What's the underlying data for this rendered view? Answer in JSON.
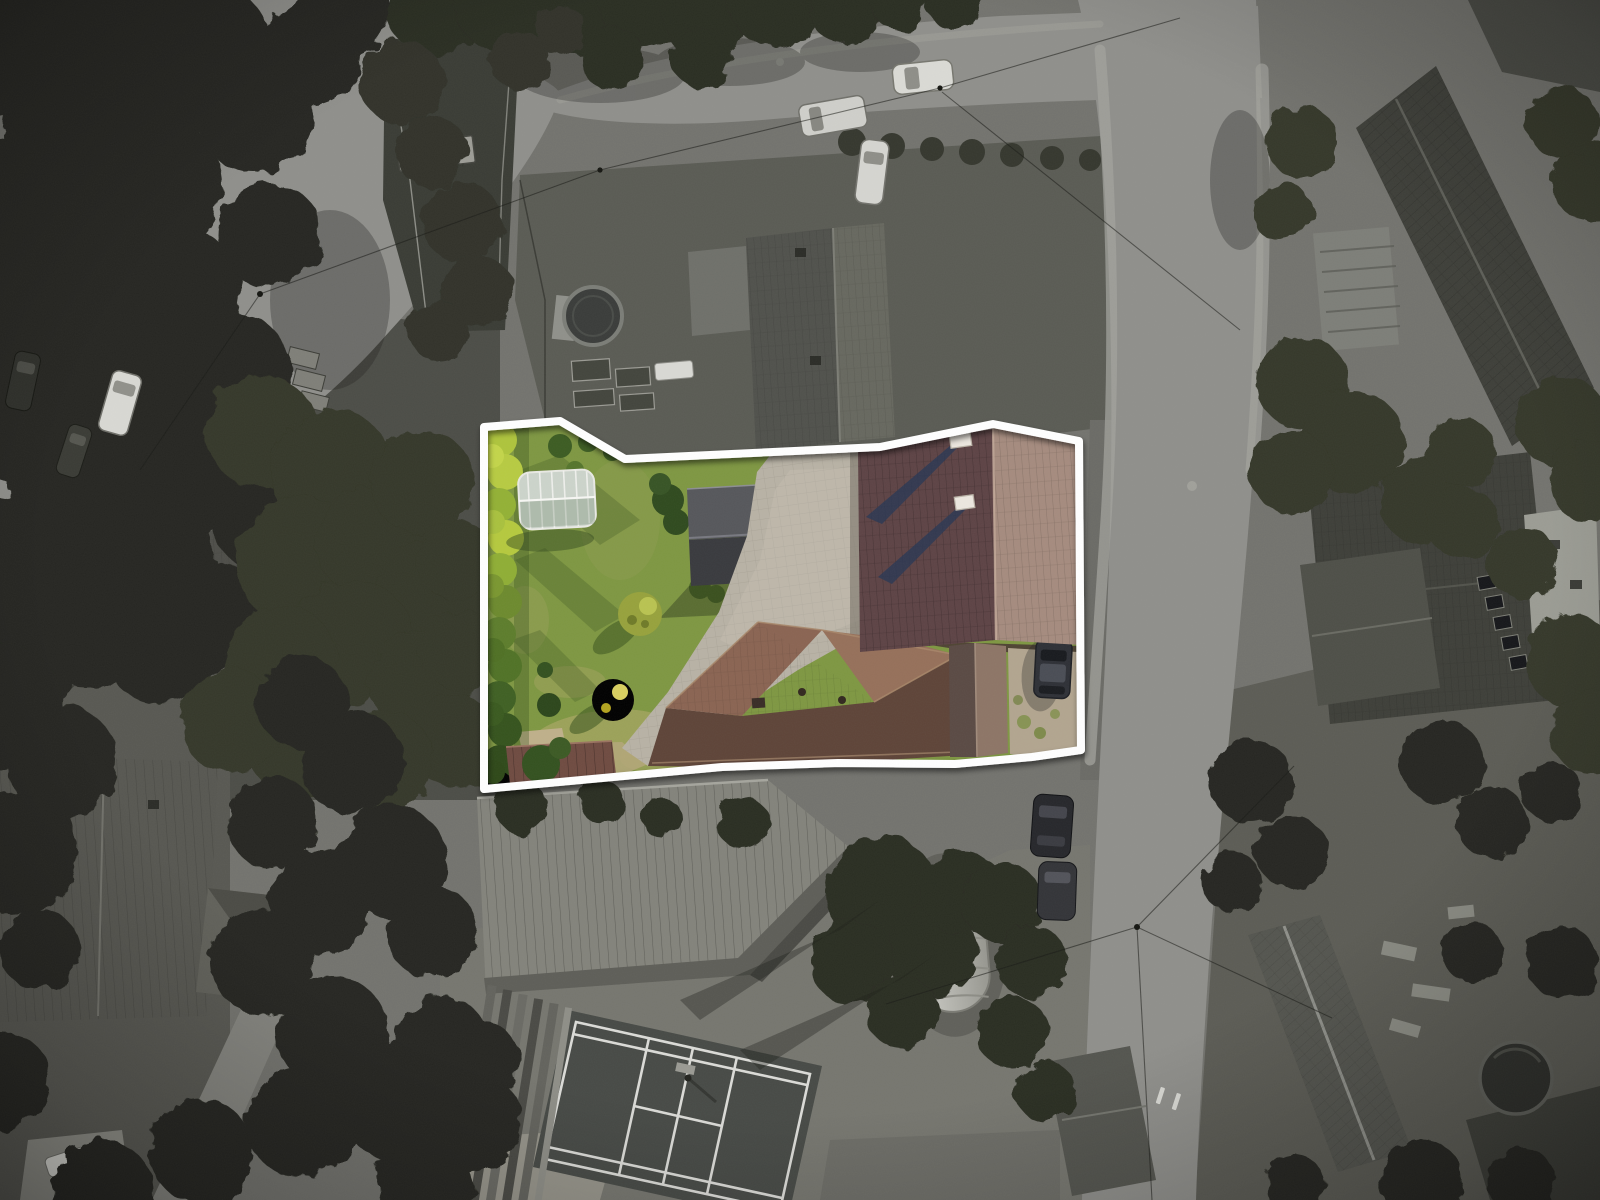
{
  "image": {
    "alt": "Aerial drone photograph of a residential neighborhood rendered in grayscale, with a single property highlighted in full color inside a thick white boundary outline",
    "width_px": 1600,
    "height_px": 1200
  },
  "property": {
    "boundary_color": "#ffffff",
    "features": [
      "green lawn",
      "hedge row on left",
      "arched greenhouse",
      "dark garden shed",
      "light paved courtyard",
      "large brown tiled main roof with two white chimneys",
      "second brown hip roof house",
      "gravel parking with dark car",
      "yellow and olive bushes",
      "small maroon corrugated roof"
    ]
  },
  "surroundings": {
    "features": [
      "curved street intersection top left",
      "street along top edge",
      "vertical street on right",
      "neighbor house with circular pool and garden beds",
      "large barn with corrugated roof",
      "badminton court with white lines",
      "covered elongated pool",
      "parked cars",
      "dense dark trees",
      "gray tiled house roofs",
      "small round pool bottom right"
    ]
  },
  "colors": {
    "ground": "#73736e",
    "ground_dark": "#55554f",
    "road": "#8f8f8b",
    "road_edge": "#a6a6a0",
    "tree": "#262821",
    "tree_mid": "#343729",
    "roof_gray": "#54554f",
    "roof_gray_dark": "#3e3f39",
    "barn_roof": "#83837b",
    "court_surface": "#474a46",
    "court_line": "#e8e8e4",
    "pool_cover": "#bcbcb6",
    "pool_water": "#3a3c3a",
    "lawn": "#7e9742",
    "lawn_dry": "#a7a562",
    "hedge_bright": "#b5c93e",
    "hedge_dark": "#3f5c22",
    "greenhouse": "#ccd4cb",
    "shed_roof": "#56575b",
    "courtyard": "#b8b2a5",
    "main_roof_west": "#5d4345",
    "main_roof_east": "#a58b7e",
    "chimney": "#ece7df",
    "chimney_shadow": "#2c3752",
    "house2_roof_light": "#8a6452",
    "house2_roof_dark": "#5e4438",
    "gravel": "#b2a58f",
    "car_dark": "#2e3036",
    "car_white": "#dadad5",
    "boundary": "#ffffff"
  }
}
